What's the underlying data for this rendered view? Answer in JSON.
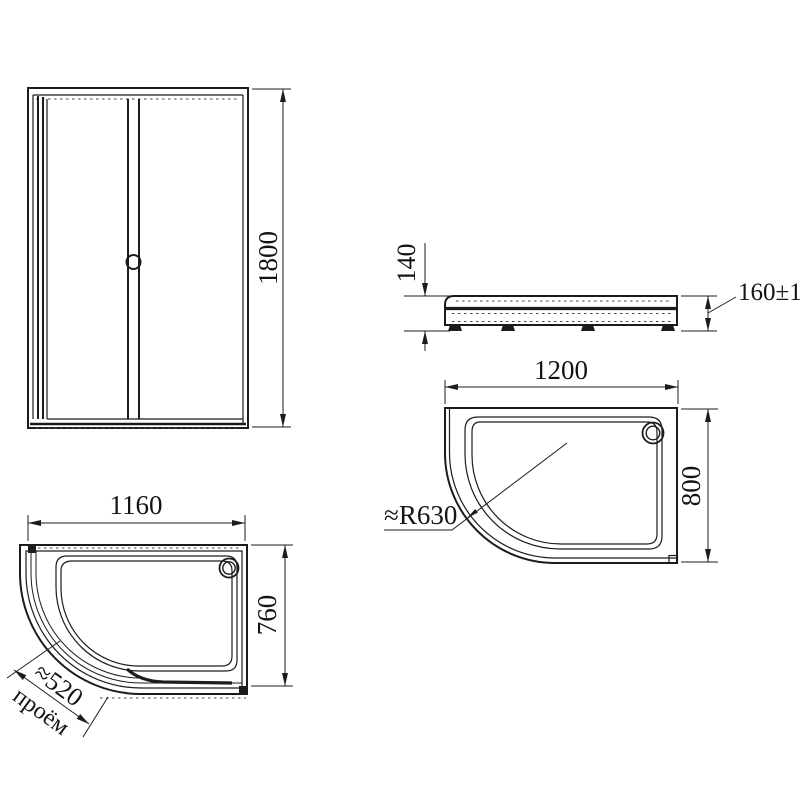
{
  "colors": {
    "line": "#1c1c1c",
    "background": "#ffffff"
  },
  "views": {
    "front": {
      "height": "1800"
    },
    "side": {
      "tray_height": "140",
      "install_height": "160±15"
    },
    "tray_top": {
      "width": "1200",
      "depth": "800",
      "radius": "≈R630"
    },
    "enclosure_top": {
      "width": "1160",
      "depth": "760",
      "opening_size": "≈520",
      "opening_word": "проём"
    }
  }
}
